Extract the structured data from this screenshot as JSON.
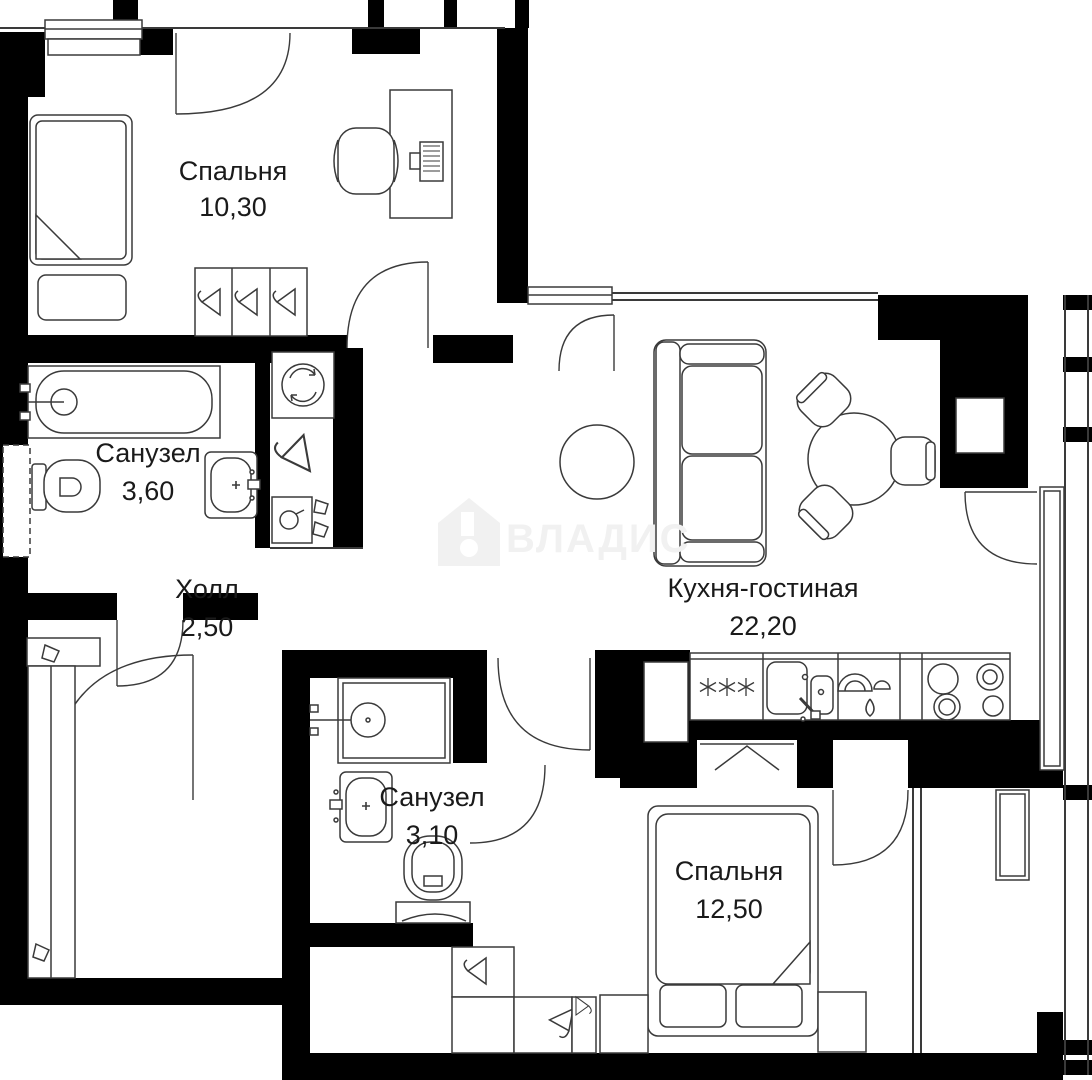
{
  "plan": {
    "title": "Floor plan of a 2-bedroom apartment",
    "rooms": [
      {
        "name": "Спальня",
        "area": "10,30"
      },
      {
        "name": "Санузел",
        "area": "3,60"
      },
      {
        "name": "Холл",
        "area": "2,50"
      },
      {
        "name": "Кухня-гостиная",
        "area": "22,20"
      },
      {
        "name": "Санузел",
        "area": "3,10"
      },
      {
        "name": "Спальня",
        "area": "12,50"
      }
    ],
    "watermark": {
      "text": "ВЛАДИС"
    },
    "colors": {
      "wall": "#000000",
      "line": "#3a3a3a",
      "bg": "#ffffff",
      "watermark": "#f1f1f1",
      "text": "#1a1a1a"
    }
  }
}
